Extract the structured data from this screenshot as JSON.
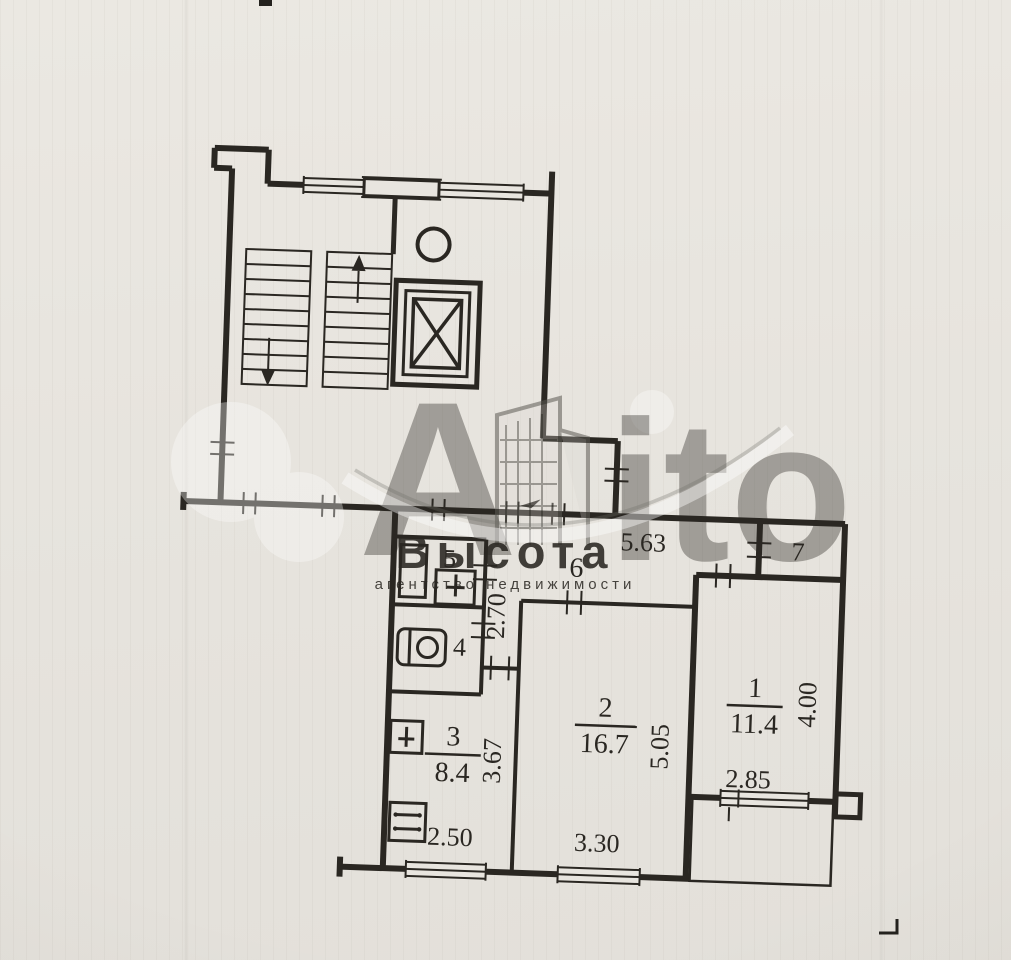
{
  "colors": {
    "paper": "#e8e5df",
    "ink": "#2a2722",
    "watermark_white": "#ffffff",
    "watermark_gray": "#b7b5b0"
  },
  "watermark": {
    "brand_a": "A",
    "brand_rest": "ito",
    "agency": "Высота",
    "agency_subtitle": "агентство недвижимости"
  },
  "plan": {
    "rooms": [
      {
        "number": "1",
        "area": "11.4"
      },
      {
        "number": "2",
        "area": "16.7"
      },
      {
        "number": "3",
        "area": "8.4"
      },
      {
        "number": "4"
      },
      {
        "number": "5"
      },
      {
        "number": "6"
      },
      {
        "number": "7"
      }
    ],
    "dimensions": {
      "hallway_length": "5.63",
      "hallway_width": "2.70",
      "kitchen_width": "2.50",
      "kitchen_length": "3.67",
      "room2_width": "3.30",
      "room2_length": "5.05",
      "room1_width": "2.85",
      "room1_length": "4.00"
    }
  }
}
